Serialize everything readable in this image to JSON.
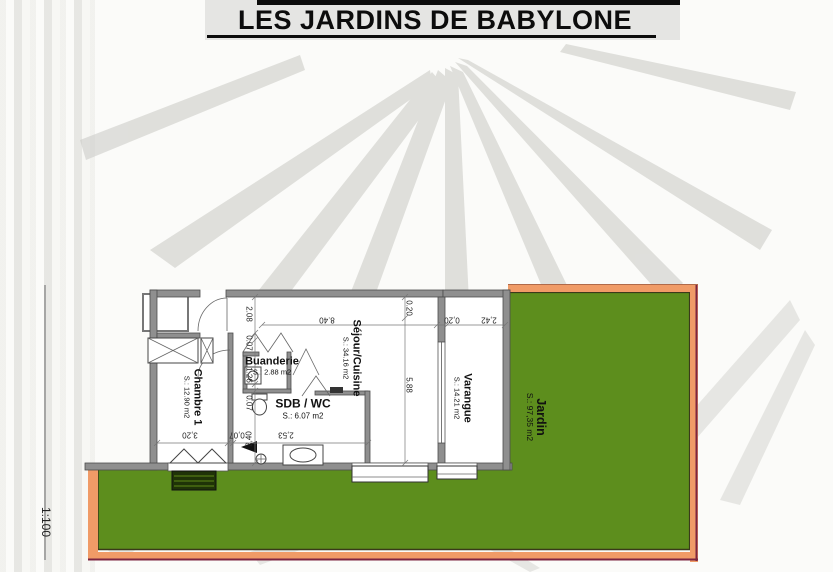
{
  "title": "LES JARDINS DE BABYLONE",
  "scale_label": "1:100",
  "colors": {
    "garden_green": "#5d8e1d",
    "plot_orange": "#f09b67",
    "plot_line": "#7d2540",
    "wall_gray": "#8f8f8f"
  },
  "rooms": {
    "chambre": {
      "name": "Chambre 1",
      "area": "S.: 12.90 m2"
    },
    "buanderie": {
      "name": "Buanderie",
      "area": "S.: 2.88 m2"
    },
    "sdb": {
      "name": "SDB / WC",
      "area": "S.:  6.07 m2"
    },
    "sejour": {
      "name": "Séjour/Cuisine",
      "area": "S.: 34.16 m2"
    },
    "varangue": {
      "name": "Varangue",
      "area": "S.: 14.21 m2"
    },
    "jardin": {
      "name": "Jardin",
      "area": "S.: 97,35 m2"
    }
  },
  "dimensions": {
    "left_chain": [
      "2.08",
      "0.07",
      "1.26",
      "0.07",
      "2,40"
    ],
    "top_chain": [
      "8.40",
      "0,20",
      "2,42"
    ],
    "right_chain": [
      "0.20",
      "5.88"
    ],
    "bottom_chain": [
      "3,20",
      "0,07",
      "2,53"
    ]
  }
}
